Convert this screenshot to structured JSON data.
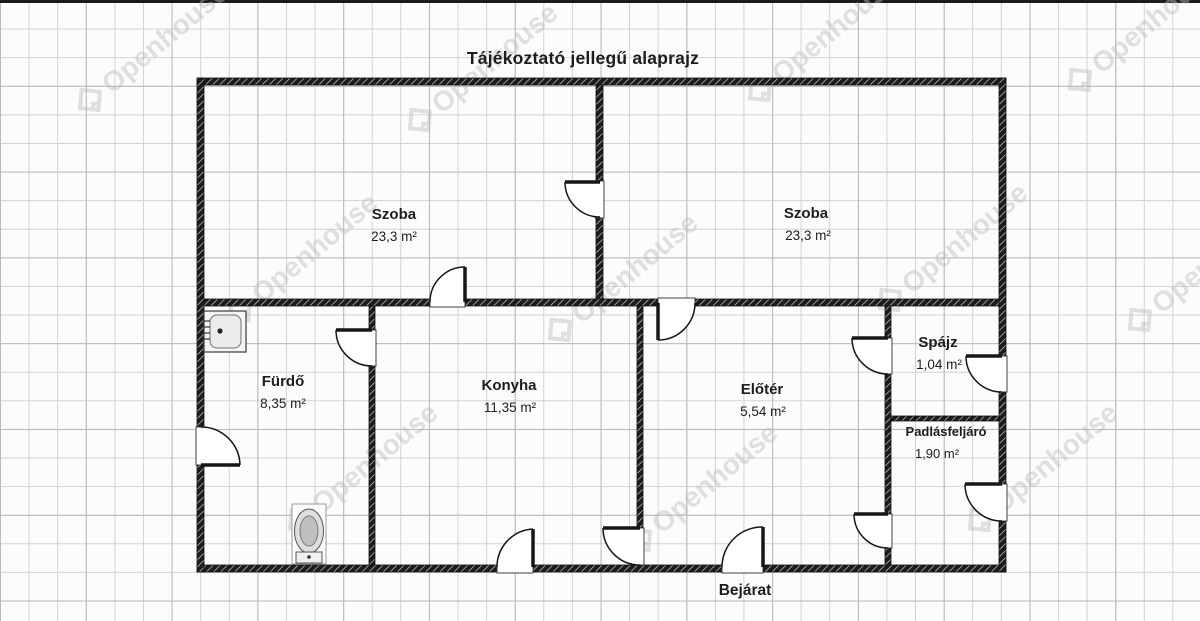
{
  "title": "Tájékoztató jellegű alaprajz",
  "entrance_label": "Bejárat",
  "watermark": {
    "text": "Openhouse",
    "positions": [
      [
        90,
        100
      ],
      [
        420,
        120
      ],
      [
        760,
        90
      ],
      [
        1080,
        80
      ],
      [
        240,
        310
      ],
      [
        560,
        330
      ],
      [
        890,
        300
      ],
      [
        1140,
        320
      ],
      [
        300,
        520
      ],
      [
        640,
        540
      ],
      [
        980,
        520
      ]
    ]
  },
  "colors": {
    "wall": "#1c1c1c",
    "line": "#161616",
    "grid": "#c6c6c6",
    "label": "#1d1d1d",
    "watermark": "#bdbdbd"
  },
  "rooms": [
    {
      "id": "szoba-left",
      "name": "Szoba",
      "area": "23,3 m²",
      "nx": 394,
      "ny": 219,
      "ax": 394,
      "ay": 241,
      "name_size": 15,
      "area_size": 13.5
    },
    {
      "id": "szoba-right",
      "name": "Szoba",
      "area": "23,3 m²",
      "nx": 806,
      "ny": 218,
      "ax": 808,
      "ay": 240,
      "name_size": 15,
      "area_size": 13.5
    },
    {
      "id": "furdo",
      "name": "Fürdő",
      "area": "8,35 m²",
      "nx": 283,
      "ny": 386,
      "ax": 283,
      "ay": 408,
      "name_size": 15,
      "area_size": 13.5
    },
    {
      "id": "konyha",
      "name": "Konyha",
      "area": "11,35 m²",
      "nx": 509,
      "ny": 390,
      "ax": 510,
      "ay": 412,
      "name_size": 15,
      "area_size": 13.5
    },
    {
      "id": "eloter",
      "name": "Előtér",
      "area": "5,54 m²",
      "nx": 762,
      "ny": 394,
      "ax": 763,
      "ay": 416,
      "name_size": 15,
      "area_size": 13.5
    },
    {
      "id": "spajz",
      "name": "Spájz",
      "area": "1,04 m²",
      "nx": 938,
      "ny": 347,
      "ax": 939,
      "ay": 369,
      "name_size": 15,
      "area_size": 13.5
    },
    {
      "id": "padlasfeljaro",
      "name": "Padlásfeljáró",
      "area": "1,90 m²",
      "nx": 946,
      "ny": 436,
      "ax": 937,
      "ay": 458,
      "name_size": 13,
      "area_size": 13
    }
  ],
  "plan": {
    "walls": [
      {
        "id": "wall-top",
        "x": 197,
        "y": 78,
        "w": 809,
        "h": 7
      },
      {
        "id": "wall-bottom",
        "x": 197,
        "y": 565,
        "w": 809,
        "h": 7
      },
      {
        "id": "wall-left",
        "x": 197,
        "y": 78,
        "w": 7,
        "h": 494
      },
      {
        "id": "wall-right",
        "x": 999,
        "y": 78,
        "w": 7,
        "h": 494
      },
      {
        "id": "wall-szoba-divider",
        "x": 596,
        "y": 85,
        "w": 7,
        "h": 214
      },
      {
        "id": "wall-horizontal",
        "x": 204,
        "y": 299,
        "w": 795,
        "h": 7
      },
      {
        "id": "wall-furdo-konyha",
        "x": 369,
        "y": 306,
        "w": 6,
        "h": 259
      },
      {
        "id": "wall-konyha-eloter",
        "x": 637,
        "y": 306,
        "w": 6,
        "h": 259
      },
      {
        "id": "wall-eloter-spajz",
        "x": 885,
        "y": 306,
        "w": 6,
        "h": 259
      },
      {
        "id": "wall-spajz-padlas",
        "x": 891,
        "y": 416,
        "w": 108,
        "h": 5
      }
    ],
    "openings": [
      {
        "x": 595,
        "y": 181,
        "w": 9,
        "h": 37
      },
      {
        "x": 430,
        "y": 298,
        "w": 35,
        "h": 9
      },
      {
        "x": 658,
        "y": 298,
        "w": 37,
        "h": 9
      },
      {
        "x": 368,
        "y": 330,
        "w": 8,
        "h": 36
      },
      {
        "x": 636,
        "y": 528,
        "w": 8,
        "h": 37
      },
      {
        "x": 884,
        "y": 338,
        "w": 8,
        "h": 36
      },
      {
        "x": 884,
        "y": 514,
        "w": 8,
        "h": 34
      },
      {
        "x": 196,
        "y": 427,
        "w": 9,
        "h": 38
      },
      {
        "x": 998,
        "y": 356,
        "w": 9,
        "h": 36
      },
      {
        "x": 998,
        "y": 484,
        "w": 9,
        "h": 37
      },
      {
        "x": 497,
        "y": 564,
        "w": 36,
        "h": 9
      },
      {
        "x": 722,
        "y": 564,
        "w": 41,
        "h": 9
      }
    ],
    "doors": [
      {
        "id": "door-szoba-szoba",
        "hinge": [
          600,
          182
        ],
        "tip": [
          565,
          182
        ],
        "end": [
          600,
          217
        ]
      },
      {
        "id": "door-szoba-konyha",
        "hinge": [
          465,
          302
        ],
        "tip": [
          465,
          267
        ],
        "end": [
          430,
          302
        ]
      },
      {
        "id": "door-szoba-eloter",
        "hinge": [
          658,
          303
        ],
        "tip": [
          658,
          340
        ],
        "end": [
          695,
          303
        ]
      },
      {
        "id": "door-furdo",
        "hinge": [
          372,
          330
        ],
        "tip": [
          336,
          330
        ],
        "end": [
          372,
          366
        ]
      },
      {
        "id": "door-furdo-exterior",
        "hinge": [
          201,
          465
        ],
        "tip": [
          240,
          465
        ],
        "end": [
          201,
          427
        ]
      },
      {
        "id": "door-konyha-exterior",
        "hinge": [
          533,
          567
        ],
        "tip": [
          533,
          529
        ],
        "end": [
          497,
          567
        ]
      },
      {
        "id": "door-konyha-eloter",
        "hinge": [
          640,
          528
        ],
        "tip": [
          603,
          528
        ],
        "end": [
          640,
          565
        ]
      },
      {
        "id": "door-bejarat",
        "hinge": [
          763,
          567
        ],
        "tip": [
          763,
          527
        ],
        "end": [
          722,
          567
        ]
      },
      {
        "id": "door-spajz",
        "hinge": [
          888,
          338
        ],
        "tip": [
          852,
          338
        ],
        "end": [
          888,
          374
        ]
      },
      {
        "id": "door-spajz-exterior",
        "hinge": [
          1002,
          356
        ],
        "tip": [
          966,
          356
        ],
        "end": [
          1002,
          392
        ]
      },
      {
        "id": "door-padlas-exterior",
        "hinge": [
          1002,
          484
        ],
        "tip": [
          965,
          484
        ],
        "end": [
          1002,
          521
        ]
      },
      {
        "id": "door-padlas-eloter",
        "hinge": [
          888,
          514
        ],
        "tip": [
          854,
          514
        ],
        "end": [
          888,
          548
        ]
      }
    ],
    "fixtures": {
      "sink": {
        "x": 204,
        "y": 311,
        "w": 42,
        "h": 41
      },
      "toilet": {
        "x": 292,
        "y": 504,
        "w": 34,
        "h": 60
      }
    }
  }
}
